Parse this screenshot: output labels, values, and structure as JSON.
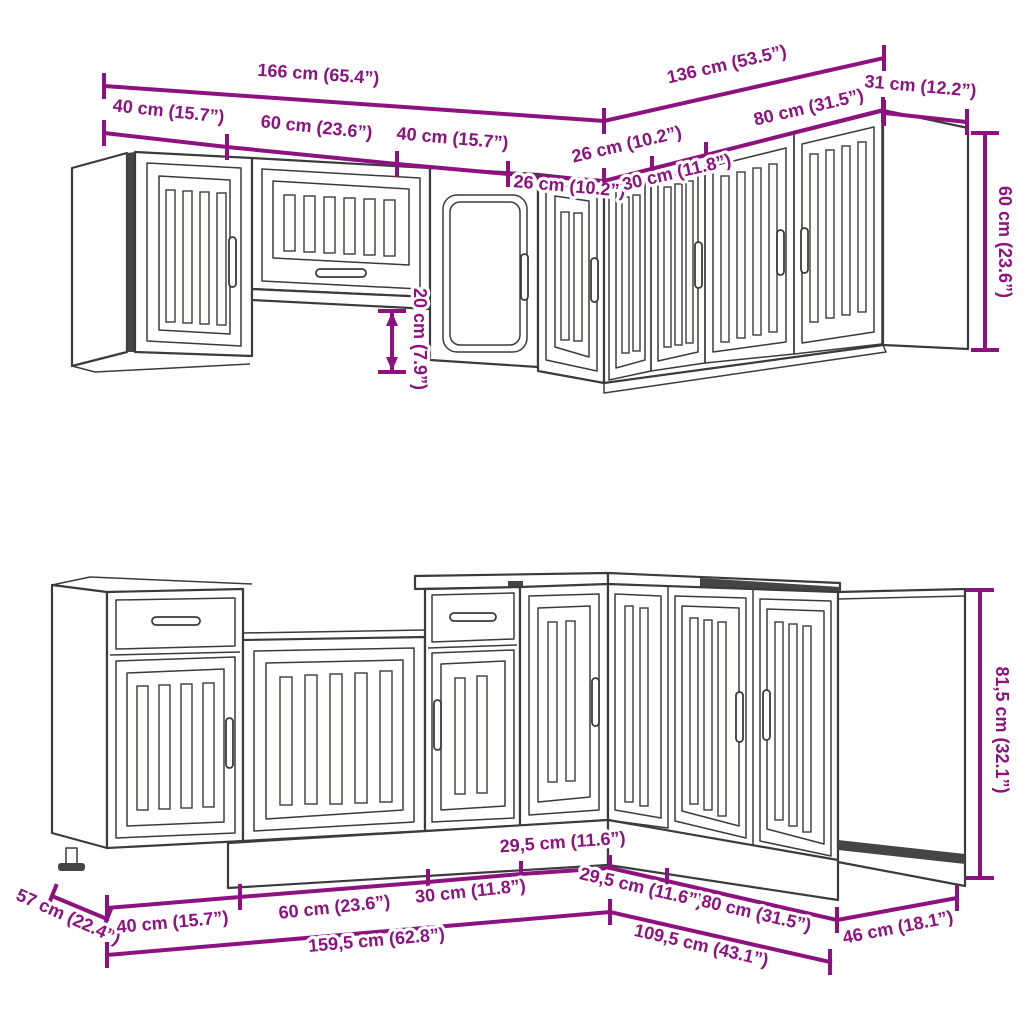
{
  "colors": {
    "dimension_line": "#8e1180",
    "cabinet_outline": "#3b3b3b",
    "dark_accent": "#454544",
    "background": "#ffffff"
  },
  "wall_section": {
    "dims": {
      "front_total": "166 cm (65.4”)",
      "right_total": "136 cm (53.5”)",
      "side_depth": "31 cm (12.2”)",
      "front_unit_1": "40 cm (15.7”)",
      "front_unit_2": "60 cm (23.6”)",
      "front_unit_3": "40 cm (15.7”)",
      "front_unit_4": "26 cm (10.2”)",
      "right_unit_1": "26 cm (10.2”)",
      "right_unit_2": "30 cm (11.8”)",
      "right_unit_3": "80 cm (31.5”)",
      "cabinet_height": "60 cm (23.6”)",
      "height_offset": "20 cm (7.9”)"
    }
  },
  "base_section": {
    "dims": {
      "cabinet_height": "81,5 cm (32.1”)",
      "side_depth_left": "57 cm (22.4”)",
      "side_depth_right": "46 cm (18.1”)",
      "front_unit_1": "40 cm (15.7”)",
      "front_unit_2": "60 cm (23.6”)",
      "front_unit_3": "30 cm (11.8”)",
      "front_unit_4": "29,5 cm (11.6”)",
      "right_unit_1": "29,5 cm (11.6”)",
      "right_unit_2": "80 cm (31.5”)",
      "front_total": "159,5 cm (62.8”)",
      "right_total": "109,5 cm (43.1”)"
    }
  }
}
